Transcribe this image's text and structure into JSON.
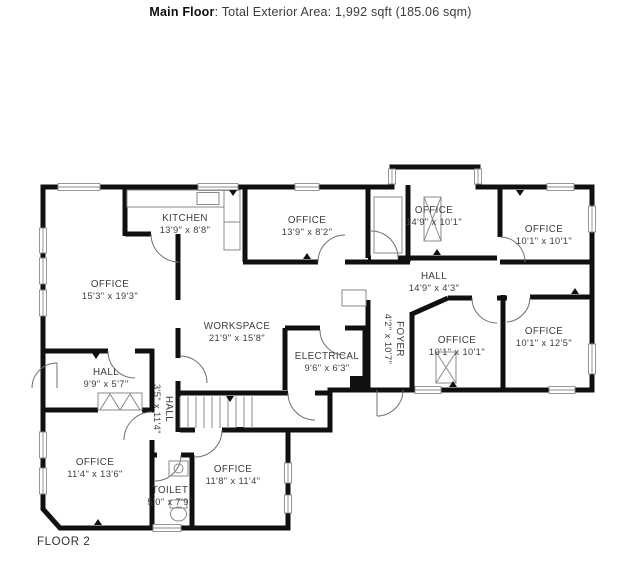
{
  "header": {
    "floor_name": "Main Floor",
    "area_text": ": Total Exterior Area: 1,992 sqft (185.06 sqm)"
  },
  "floor_label": "FLOOR 2",
  "rooms": [
    {
      "name": "KITCHEN",
      "dims": "13'9\" x 8'8\""
    },
    {
      "name": "OFFICE",
      "dims": "13'9\" x 8'2\""
    },
    {
      "name": "OFFICE",
      "dims": "14'9\" x 10'1\""
    },
    {
      "name": "OFFICE",
      "dims": "10'1\" x 10'1\""
    },
    {
      "name": "OFFICE",
      "dims": "15'3\" x 19'3\""
    },
    {
      "name": "HALL",
      "dims": "14'9\" x 4'3\""
    },
    {
      "name": "WORKSPACE",
      "dims": "21'9\" x 15'8\""
    },
    {
      "name": "ELECTRICAL",
      "dims": "9'6\" x 6'3\""
    },
    {
      "name": "FOYER",
      "dims": "4'2\" x 10'7\""
    },
    {
      "name": "OFFICE",
      "dims": "10'1\" x 10'1\""
    },
    {
      "name": "OFFICE",
      "dims": "10'1\" x 12'5\""
    },
    {
      "name": "HALL",
      "dims": "9'9\" x 5'7\""
    },
    {
      "name": "HALL",
      "dims": "3'5\" x 11'4\""
    },
    {
      "name": "OFFICE",
      "dims": "11'4\" x 13'6\""
    },
    {
      "name": "OFFICE",
      "dims": "11'8\" x 11'4\""
    },
    {
      "name": "TOILET",
      "dims": "5'0\" x 7'9\""
    }
  ],
  "colors": {
    "wall": "#101010",
    "label_text": "#3d3d3d",
    "window_line": "#8c8c8c",
    "header_text": "#0d0d0d"
  }
}
